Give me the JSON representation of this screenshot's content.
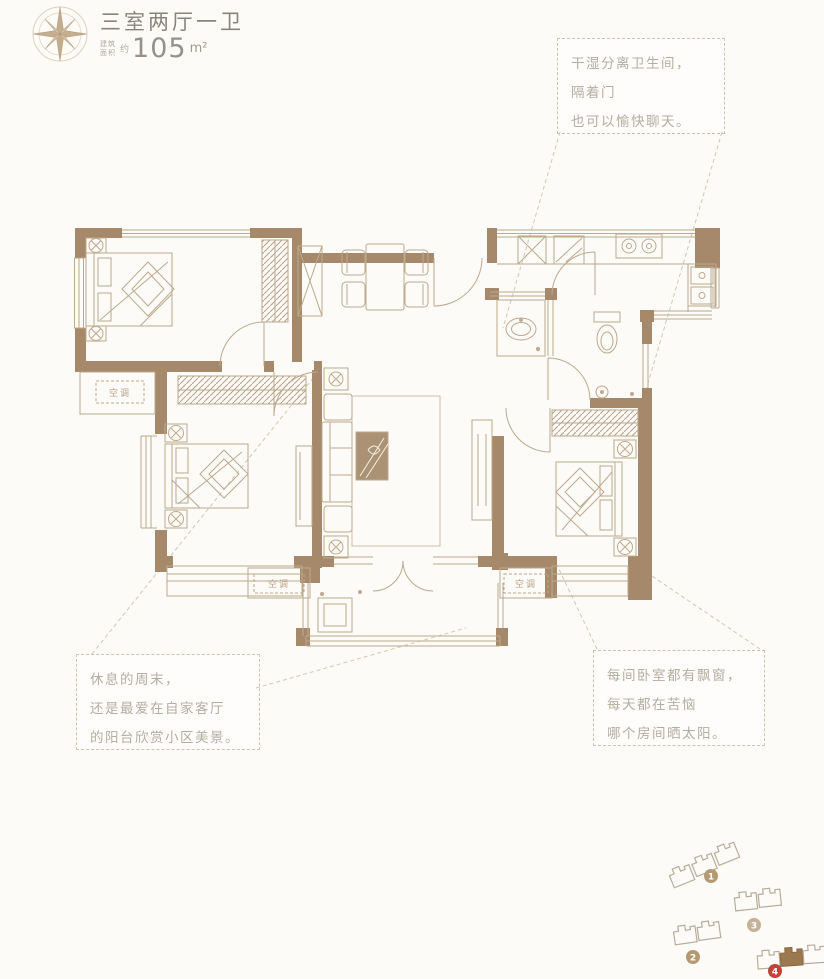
{
  "header": {
    "title": "三室两厅一卫",
    "area_label_line1": "建筑",
    "area_label_line2": "面积",
    "area_approx": "约",
    "area_value": "105",
    "area_unit": "m²"
  },
  "callouts": {
    "bathroom": {
      "lines": [
        "干湿分离卫生间，",
        "隔着门",
        "也可以愉快聊天。"
      ]
    },
    "balcony": {
      "lines": [
        "休息的周末，",
        "还是最爱在自家客厅",
        "的阳台欣赏小区美景。"
      ]
    },
    "bedroom": {
      "lines": [
        "每间卧室都有飘窗，",
        "每天都在苦恼",
        "哪个房间晒太阳。"
      ]
    }
  },
  "floorplan": {
    "ac_label": "空调"
  },
  "siteplan": {
    "buildings": [
      {
        "number": "1",
        "highlighted": false
      },
      {
        "number": "2",
        "highlighted": false
      },
      {
        "number": "3",
        "highlighted": false
      },
      {
        "number": "4",
        "highlighted": true
      }
    ]
  },
  "colors": {
    "wall": "#a5896a",
    "furniture_line": "#b9a287",
    "text_primary": "#8a857c",
    "text_callout": "#b5ad9f",
    "badge_tan": "#b49a72",
    "badge_light": "#c4b296",
    "badge_red": "#c0443a"
  }
}
